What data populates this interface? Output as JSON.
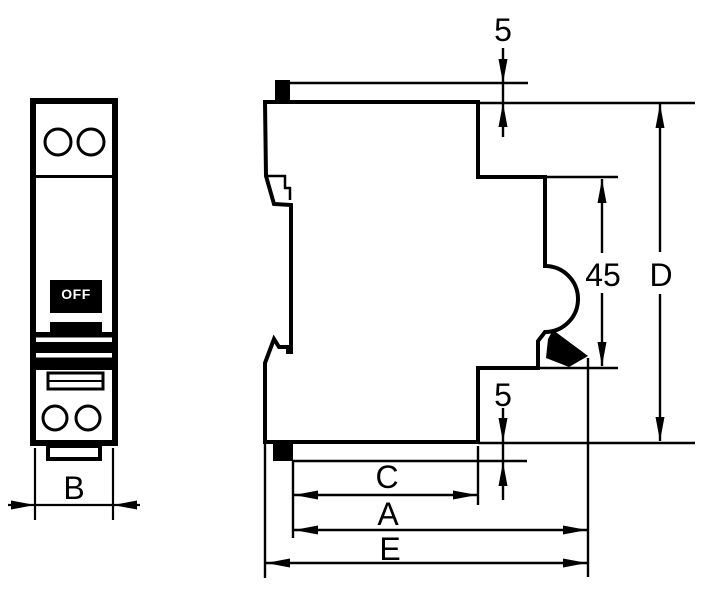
{
  "drawing": {
    "type": "technical-dimension-drawing",
    "subject": "single-pole miniature circuit breaker, front view and side profile"
  },
  "colors": {
    "line": "#000000",
    "background": "#ffffff",
    "toggle_bg": "#000000",
    "toggle_text": "#ffffff"
  },
  "front_view": {
    "toggle_label": "OFF",
    "width_dimension": "B"
  },
  "side_view": {
    "top_offset_dimension": "5",
    "right_height_dimension": "45",
    "overall_height_dimension": "D",
    "bottom_offset_dimension": "5",
    "inner_width_dimension": "C",
    "mid_width_dimension": "A",
    "overall_width_dimension": "E"
  },
  "labels": {
    "b": "B",
    "c": "C",
    "a": "A",
    "e": "E",
    "d": "D",
    "h45": "45",
    "five_top": "5",
    "five_bottom": "5"
  }
}
